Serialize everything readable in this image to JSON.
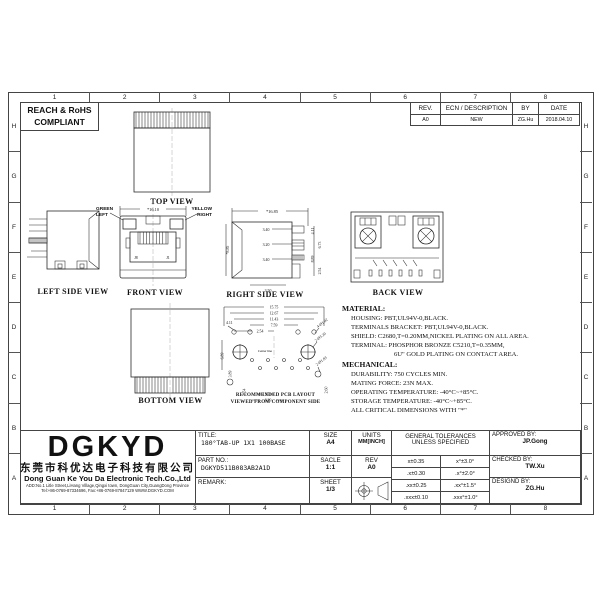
{
  "sheet": {
    "compliance_line1": "REACH & RoHS",
    "compliance_line2": "COMPLIANT",
    "grid_cols": [
      "1",
      "2",
      "3",
      "4",
      "5",
      "6",
      "7",
      "8"
    ],
    "grid_rows": [
      "H",
      "G",
      "F",
      "E",
      "D",
      "C",
      "B",
      "A"
    ]
  },
  "revision_table": {
    "headers": [
      "REV.",
      "ECN / DESCRIPTION",
      "BY",
      "DATE"
    ],
    "rows": [
      [
        "A0",
        "NEW",
        "ZG.Hu",
        "2018.04.10"
      ]
    ]
  },
  "views": {
    "top_caption": "TOP VIEW",
    "left_caption": "LEFT SIDE VIEW",
    "front_caption": "FRONT VIEW",
    "right_caption": "RIGHT SIDE VIEW",
    "back_caption": "BACK VIEW",
    "bottom_caption": "BOTTOM VIEW",
    "pcb_caption_line1": "RECOMMENDED PCB LAYOUT",
    "pcb_caption_line2": "VIEWED FROM COMPONENT SIDE"
  },
  "front_view": {
    "green_label_1": "GREEN",
    "green_label_2": "LEFT",
    "yellow_label_1": "YELLOW",
    "yellow_label_2": "RIGHT",
    "width_dim": "*16.10",
    "j8": "J8",
    "j1": "J1",
    "green_color": "#00c800",
    "yellow_color": "#e8e400"
  },
  "right_view": {
    "width_dim": "*16.85",
    "height_dim": "*8.85",
    "d1": "3.40",
    "d2": "3.20",
    "d3": "3.40",
    "r1": "4.11",
    "r2": "6.73",
    "r3": "8.89",
    "r4": "2.54",
    "bottom_dim": "3.50"
  },
  "pcb_view": {
    "w1": "15.75",
    "w2": "12.67",
    "w3": "11.43",
    "w4": "7.59",
    "w5": "2.54",
    "l1": "4.11",
    "l2": "6.89",
    "l3": "3.89",
    "b1": "2.54",
    "b2": "1.27",
    "b3": "6.89",
    "r1": "2.60",
    "callout_small": "4-Ø1.02",
    "callout_large": "2-Ø3.20",
    "callout_ground": "2-Ø1.83",
    "center_label": "Center line"
  },
  "material": {
    "title": "MATERIAL:",
    "lines": [
      "HOUSING: PBT,UL94V-0,BLACK.",
      "TERMINALS BRACKET: PBT,UL94V-0,BLACK.",
      "SHIELD: C2680,T=0.20MM,NICKEL PLATING ON ALL AREA.",
      "TERMINAL: PHOSPHOR BRONZE C5210,T=0.35MM,",
      "6U\" GOLD PLATING ON CONTACT AREA."
    ]
  },
  "mechanical": {
    "title": "MECHANICAL:",
    "lines": [
      "DURABILITY: 750 CYCLES MIN.",
      "MATING FORCE: 23N MAX.",
      "OPERATING TEMPERATURE: -40°C~+85°C.",
      "STORAGE TEMPERATURE: -40°C~+85°C.",
      "ALL CRITICAL DIMENSIONS WITH \"*\""
    ]
  },
  "title_block": {
    "logo": "DGKYD",
    "company_cn": "东莞市科优达电子科技有限公司",
    "company_en": "Dong Guan Ke You Da Electronic Tech.Co.,Ltd",
    "address": "ADD:No.1 Litle Street,LiHang Village,Qingxi town, DongGuan City,GuangDong Province",
    "contact": "Tel:+86-0769-87334696, Fax:+86-0769-87847129  WWW.DGKYD.COM",
    "title_label": "TITLE:",
    "title_value": "180°TAB-UP 1X1 100BASE",
    "part_label": "PART NO.:",
    "part_value": "DGKYD511B083AB2A1D",
    "remark_label": "REMARK:",
    "size_label": "SIZE",
    "size_value": "A4",
    "scale_label": "SACLE",
    "scale_value": "1:1",
    "sheet_label": "SHEET",
    "sheet_value": "1/3",
    "units_label": "UNITS",
    "units_value": "MM[INCH]",
    "rev_label": "REV",
    "rev_value": "A0",
    "tol_header1": "GENERAL TOLERANCES",
    "tol_header2": "UNLESS SPECIFIED",
    "tolerances": [
      [
        "x±0.35",
        "x°±3.0°"
      ],
      [
        ".x±0.30",
        ".x°±2.0°"
      ],
      [
        ".xx±0.25",
        ".xx°±1.5°"
      ],
      [
        ".xxx±0.10",
        ".xxx°±1.0°"
      ]
    ],
    "approved_label": "APPROVED BY:",
    "approved_value": "JP.Gong",
    "checked_label": "CHECKED BY:",
    "checked_value": "TW.Xu",
    "designed_label": "DESIGND BY:",
    "designed_value": "ZG.Hu"
  }
}
